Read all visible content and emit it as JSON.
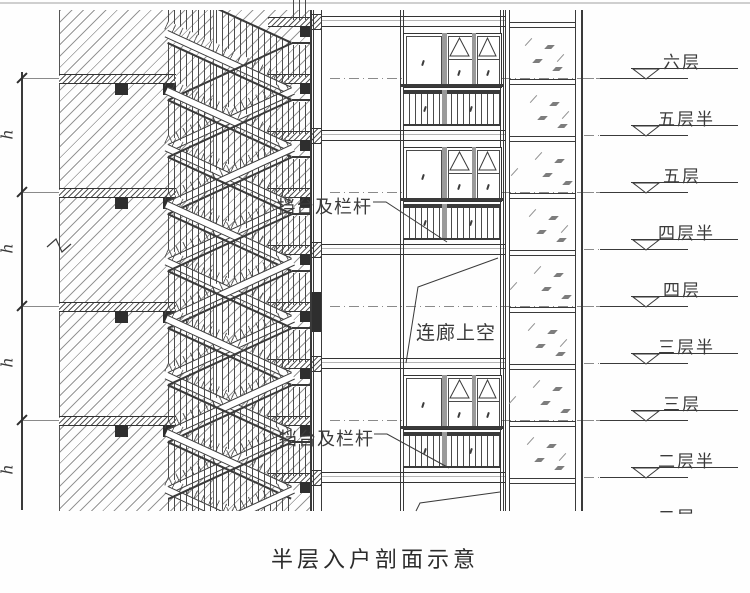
{
  "title": "半层入户剖面示意",
  "dimension": {
    "label": "h",
    "segments": 4
  },
  "annotations": {
    "parapet_upper": "挡台及栏杆",
    "parapet_lower": "挡台及栏杆",
    "corridor_void": "连廊上空"
  },
  "levels": [
    {
      "label": "六层",
      "y": 78,
      "type": "full"
    },
    {
      "label": "五层半",
      "y": 135,
      "type": "half"
    },
    {
      "label": "五层",
      "y": 192,
      "type": "full"
    },
    {
      "label": "四层半",
      "y": 249,
      "type": "half"
    },
    {
      "label": "四层",
      "y": 306,
      "type": "full"
    },
    {
      "label": "三层半",
      "y": 363,
      "type": "half"
    },
    {
      "label": "三层",
      "y": 420,
      "type": "full"
    },
    {
      "label": "二层半",
      "y": 477,
      "type": "half"
    },
    {
      "label": "二层",
      "y": 534,
      "type": "full",
      "partial": true
    }
  ],
  "window_levels": [
    78,
    192,
    420
  ],
  "line_color": "#3a3a3a"
}
